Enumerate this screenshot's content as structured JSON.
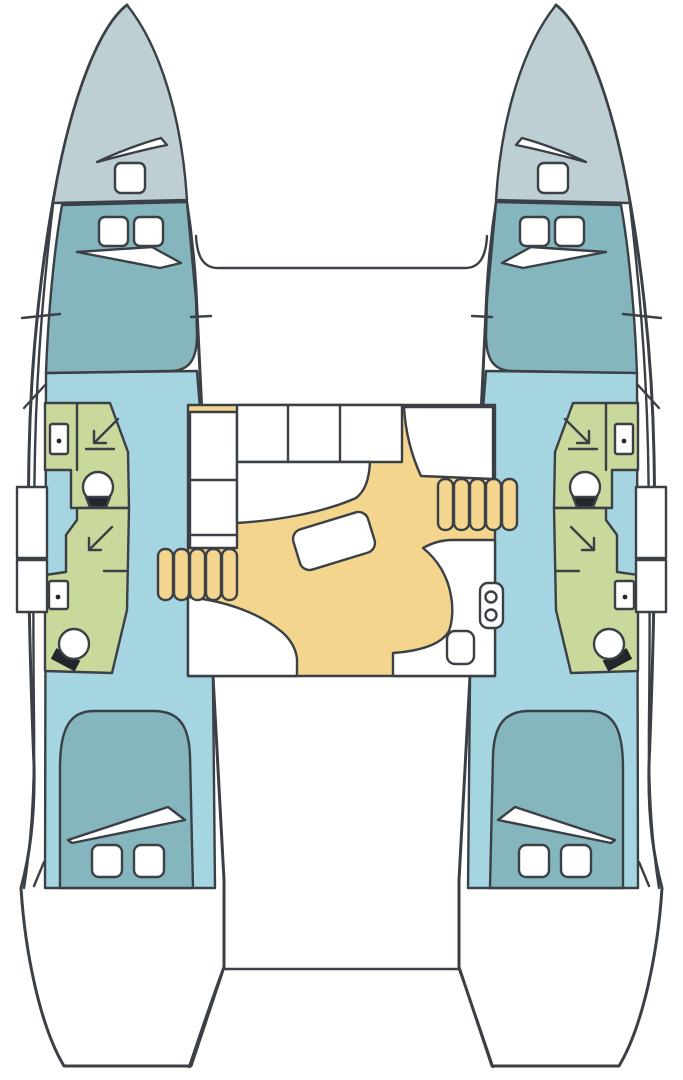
{
  "diagram": {
    "type": "floor-plan",
    "subject": "catamaran-sailboat-interior-layout",
    "orientation": "bow-up",
    "symmetry": "mirrored-hulls",
    "areas": {
      "left_hull": [
        "bow deck",
        "forward cabin berth",
        "forward head with shower, sink and toilet",
        "aft head with shower, sink and toilet",
        "aft cabin berth"
      ],
      "right_hull": [
        "bow deck",
        "forward cabin berth",
        "forward head with shower, sink and toilet",
        "aft head with shower, sink and toilet",
        "aft cabin berth"
      ],
      "center": [
        "foredeck",
        "salon with L-settee and rotated table",
        "forward-facing seat",
        "galley counter with twin-basin sink",
        "port companionway stairs",
        "starboard companionway stairs",
        "aft cockpit"
      ]
    },
    "fixtures": {
      "deck_hatches_per_hull": 5,
      "vents_per_hull": 3,
      "toilets_per_hull": 2,
      "showers_per_hull": 2,
      "sinks_per_hull": 2,
      "stair_steps_per_side": 5,
      "galley_sink_basins": 2,
      "galley_hatches": 1,
      "tables": 1
    }
  },
  "colors": {
    "outline": "#3a4045",
    "white": "#ffffff",
    "deck": "#bdcfd2",
    "berth": "#85b5bd",
    "floor": "#a5d5e1",
    "head": "#c9d99b",
    "salon": "#f3d58d",
    "fixture_dark": "#22272b"
  }
}
